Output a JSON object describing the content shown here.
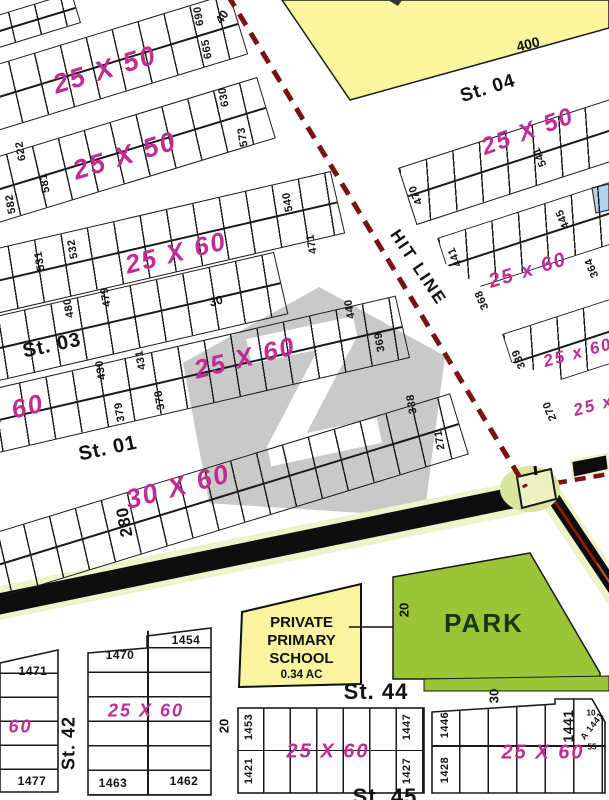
{
  "title": "housing scheme plot map",
  "watermark": {
    "letter": "Z"
  },
  "roads": {
    "hit_line": "HIT LINE"
  },
  "park": {
    "label": "PARK"
  },
  "school": {
    "line1": "PRIVATE",
    "line2": "PRIMARY",
    "line3": "SCHOOL",
    "area": "0.34 AC"
  },
  "labels": {
    "plot_numbers": [
      {
        "t": "690",
        "x": 199,
        "y": 16,
        "r": -100,
        "s": 11
      },
      {
        "t": "665",
        "x": 207,
        "y": 49,
        "r": -100,
        "s": 11
      },
      {
        "t": "630",
        "x": 224,
        "y": 97,
        "r": -100,
        "s": 11
      },
      {
        "t": "573",
        "x": 243,
        "y": 137,
        "r": -100,
        "s": 11
      },
      {
        "t": "622",
        "x": 21,
        "y": 151,
        "r": -100,
        "s": 11
      },
      {
        "t": "581",
        "x": 45,
        "y": 183,
        "r": -100,
        "s": 11
      },
      {
        "t": "582",
        "x": 11,
        "y": 204,
        "r": -100,
        "s": 11
      },
      {
        "t": "532",
        "x": 73,
        "y": 249,
        "r": -100,
        "s": 11
      },
      {
        "t": "531",
        "x": 40,
        "y": 261,
        "r": -100,
        "s": 11
      },
      {
        "t": "480",
        "x": 69,
        "y": 308,
        "r": -100,
        "s": 11
      },
      {
        "t": "479",
        "x": 106,
        "y": 297,
        "r": -100,
        "s": 11
      },
      {
        "t": "540",
        "x": 288,
        "y": 202,
        "r": -100,
        "s": 11
      },
      {
        "t": "471",
        "x": 312,
        "y": 244,
        "r": -100,
        "s": 11
      },
      {
        "t": "431",
        "x": 141,
        "y": 360,
        "r": -100,
        "s": 11
      },
      {
        "t": "430",
        "x": 101,
        "y": 370,
        "r": -100,
        "s": 11
      },
      {
        "t": "378",
        "x": 160,
        "y": 400,
        "r": -100,
        "s": 11
      },
      {
        "t": "379",
        "x": 120,
        "y": 412,
        "r": -100,
        "s": 11
      },
      {
        "t": "440",
        "x": 350,
        "y": 309,
        "r": -100,
        "s": 11
      },
      {
        "t": "369",
        "x": 380,
        "y": 342,
        "r": -100,
        "s": 11
      },
      {
        "t": "338",
        "x": 412,
        "y": 404,
        "r": -100,
        "s": 11
      },
      {
        "t": "271",
        "x": 440,
        "y": 440,
        "r": -100,
        "s": 11
      },
      {
        "t": "280",
        "x": 125,
        "y": 522,
        "r": -100,
        "s": 17
      },
      {
        "t": "541",
        "x": 540,
        "y": 157,
        "r": -113,
        "s": 11
      },
      {
        "t": "470",
        "x": 416,
        "y": 195,
        "r": -113,
        "s": 11
      },
      {
        "t": "445",
        "x": 563,
        "y": 219,
        "r": -113,
        "s": 11
      },
      {
        "t": "441",
        "x": 455,
        "y": 257,
        "r": -113,
        "s": 11
      },
      {
        "t": "364",
        "x": 592,
        "y": 268,
        "r": -113,
        "s": 11
      },
      {
        "t": "368",
        "x": 482,
        "y": 300,
        "r": -113,
        "s": 11
      },
      {
        "t": "339",
        "x": 519,
        "y": 359,
        "r": -113,
        "s": 11
      },
      {
        "t": "270",
        "x": 550,
        "y": 411,
        "r": -113,
        "s": 11
      },
      {
        "t": "1471",
        "x": 33,
        "y": 671,
        "r": 0,
        "s": 12
      },
      {
        "t": "1477",
        "x": 32,
        "y": 781,
        "r": 0,
        "s": 12
      },
      {
        "t": "1470",
        "x": 120,
        "y": 655,
        "r": 0,
        "s": 12
      },
      {
        "t": "1454",
        "x": 186,
        "y": 640,
        "r": 0,
        "s": 12
      },
      {
        "t": "1463",
        "x": 113,
        "y": 783,
        "r": 0,
        "s": 12
      },
      {
        "t": "1462",
        "x": 184,
        "y": 781,
        "r": 0,
        "s": 12
      },
      {
        "t": "1453",
        "x": 249,
        "y": 727,
        "r": -90,
        "s": 11
      },
      {
        "t": "1421",
        "x": 249,
        "y": 771,
        "r": -90,
        "s": 11
      },
      {
        "t": "1447",
        "x": 407,
        "y": 727,
        "r": -90,
        "s": 11
      },
      {
        "t": "1427",
        "x": 407,
        "y": 771,
        "r": -90,
        "s": 11
      },
      {
        "t": "1446",
        "x": 445,
        "y": 725,
        "r": -90,
        "s": 11
      },
      {
        "t": "1428",
        "x": 445,
        "y": 770,
        "r": -90,
        "s": 11
      },
      {
        "t": "1441",
        "x": 568,
        "y": 726,
        "r": -90,
        "s": 14
      },
      {
        "t": "A 1441",
        "x": 592,
        "y": 726,
        "r": -52,
        "s": 9
      }
    ],
    "size_labels": [
      {
        "t": "25 X 50",
        "x": 105,
        "y": 70,
        "r": -17,
        "s": 27
      },
      {
        "t": "25 X 50",
        "x": 125,
        "y": 156,
        "r": -17,
        "s": 27
      },
      {
        "t": "25 X 60",
        "x": 176,
        "y": 253,
        "r": -14,
        "s": 26
      },
      {
        "t": "25 X 60",
        "x": 245,
        "y": 358,
        "r": -14,
        "s": 26
      },
      {
        "t": "X 60",
        "x": 14,
        "y": 410,
        "r": -14,
        "s": 26
      },
      {
        "t": "30 X 60",
        "x": 178,
        "y": 487,
        "r": -15,
        "s": 27
      },
      {
        "t": "25 X 50",
        "x": 528,
        "y": 132,
        "r": -20,
        "s": 24
      },
      {
        "t": "25 x 60",
        "x": 528,
        "y": 271,
        "r": -17,
        "s": 20
      },
      {
        "t": "25 x 60",
        "x": 578,
        "y": 353,
        "r": -15,
        "s": 17
      },
      {
        "t": "25 x 60",
        "x": 608,
        "y": 402,
        "r": -15,
        "s": 17
      },
      {
        "t": "X 60",
        "x": 10,
        "y": 727,
        "r": 0,
        "s": 18
      },
      {
        "t": "25 X 60",
        "x": 146,
        "y": 711,
        "r": 0,
        "s": 18
      },
      {
        "t": "25 X 60",
        "x": 328,
        "y": 752,
        "r": 0,
        "s": 20
      },
      {
        "t": "25 X 60",
        "x": 543,
        "y": 753,
        "r": 0,
        "s": 20
      }
    ],
    "street_labels": [
      {
        "t": "St. 03",
        "x": 52,
        "y": 346,
        "r": -12,
        "s": 20
      },
      {
        "t": "St. 01",
        "x": 108,
        "y": 449,
        "r": -12,
        "s": 20
      },
      {
        "t": "St. 04",
        "x": 488,
        "y": 89,
        "r": -17,
        "s": 19
      },
      {
        "t": "St. 42",
        "x": 69,
        "y": 743,
        "r": -90,
        "s": 18
      },
      {
        "t": "St. 44",
        "x": 376,
        "y": 692,
        "r": 0,
        "s": 22
      },
      {
        "t": "St. 45",
        "x": 385,
        "y": 797,
        "r": 0,
        "s": 22
      }
    ],
    "dim_labels": [
      {
        "t": "40",
        "x": 222,
        "y": 17,
        "r": -55,
        "s": 12
      },
      {
        "t": "400",
        "x": 528,
        "y": 44,
        "r": -14,
        "s": 14
      },
      {
        "t": "30",
        "x": 216,
        "y": 301,
        "r": -14,
        "s": 12
      },
      {
        "t": "20",
        "x": 404,
        "y": 610,
        "r": -90,
        "s": 13
      },
      {
        "t": "30",
        "x": 494,
        "y": 696,
        "r": -90,
        "s": 13
      },
      {
        "t": "20",
        "x": 224,
        "y": 726,
        "r": -90,
        "s": 13
      },
      {
        "t": "10",
        "x": 591,
        "y": 713,
        "r": 0,
        "s": 8
      },
      {
        "t": "55",
        "x": 592,
        "y": 747,
        "r": 0,
        "s": 8
      }
    ]
  },
  "colors": {
    "size_label_pink": "#c02c92",
    "hit_line_dash": "#7a1113",
    "park_green": "#9cc437",
    "school_yellow": "#f8f4a0",
    "corner_yellow": "#faf69e",
    "road_edge": "#eef3cb",
    "road_black": "#0e0e0e",
    "watermark_grey": "#c9c9c9",
    "mosque_blue": "#b5d3ea"
  }
}
